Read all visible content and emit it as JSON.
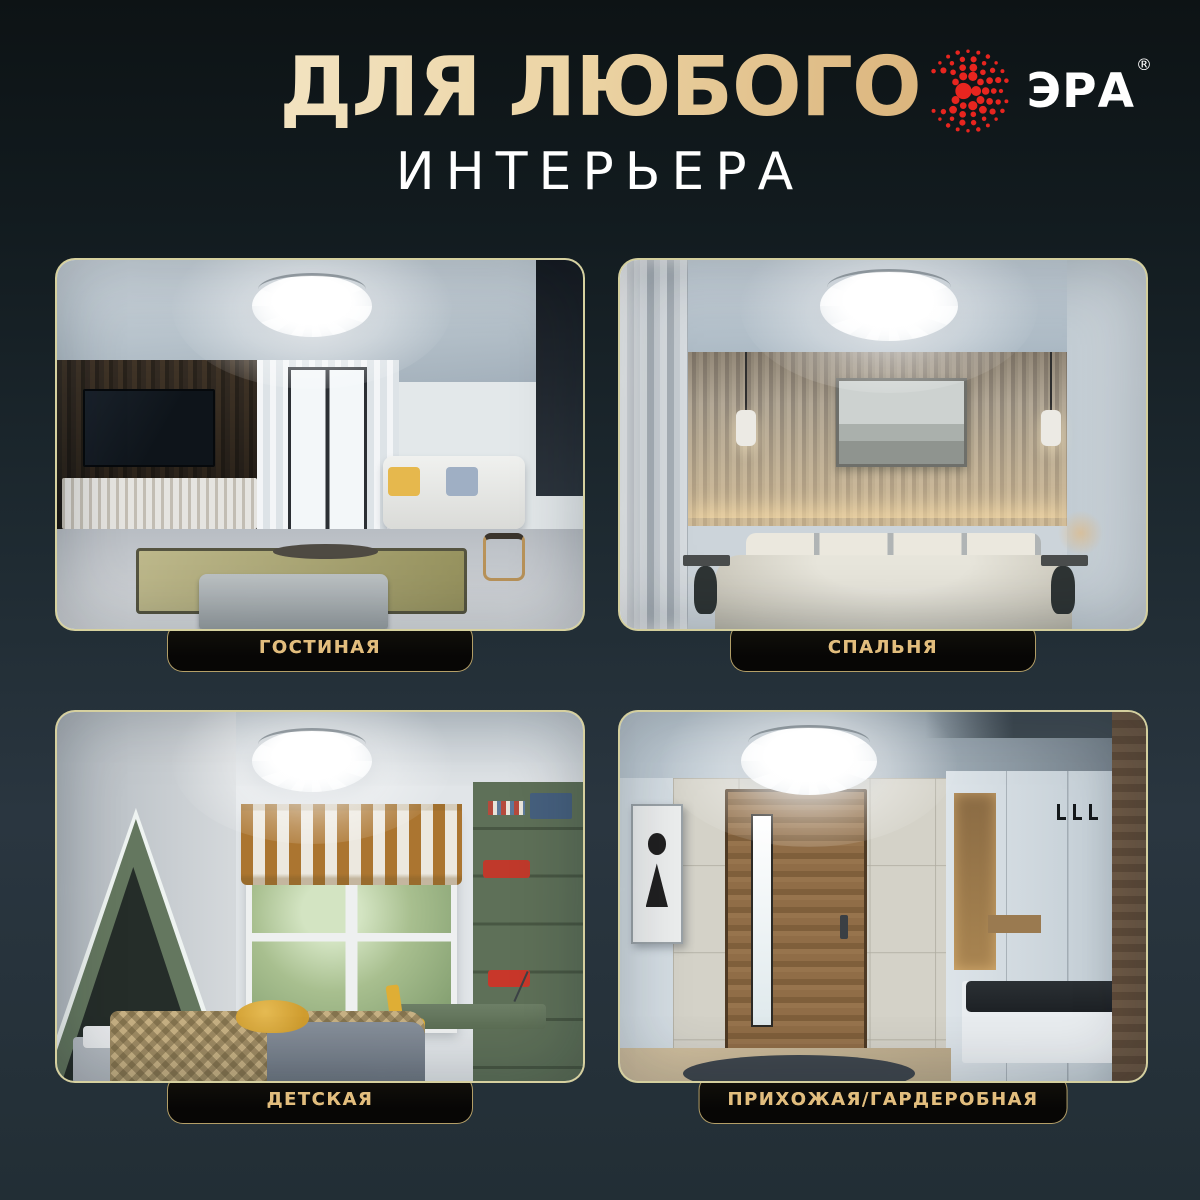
{
  "header": {
    "title_line1": "ДЛЯ ЛЮБОГО",
    "title_line2": "ИНТЕРЬЕРА"
  },
  "brand": {
    "name": "ЭРА",
    "reg_mark": "®"
  },
  "icons": {
    "era_logo": "red-dotted-sunburst-e-shape",
    "ceiling_lamp": "white-faceted-round-ceiling-light"
  },
  "rooms": [
    {
      "id": "living",
      "label": "ГОСТИНАЯ"
    },
    {
      "id": "bedroom",
      "label": "СПАЛЬНЯ"
    },
    {
      "id": "kids",
      "label": "ДЕТСКАЯ"
    },
    {
      "id": "hallway",
      "label": "ПРИХОЖАЯ/ГАРДЕРОБНАЯ"
    }
  ],
  "colors": {
    "logo_red": "#e8251f",
    "accent_gold_light": "#f6e8c2",
    "accent_gold_dark": "#cf9a55",
    "card_border_gold": "#d4cc92",
    "pill_background": "#0a0907",
    "background_top": "#0d1315",
    "background_bottom": "#222e35",
    "title_white": "#ffffff"
  }
}
